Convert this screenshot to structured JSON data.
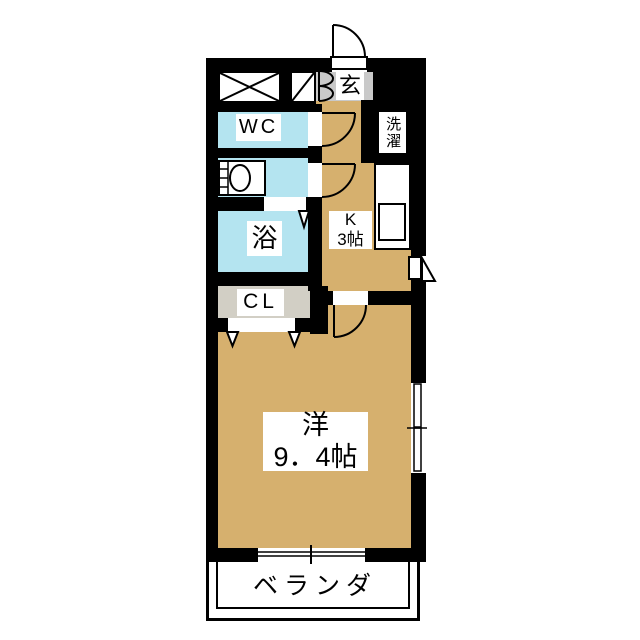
{
  "floorplan": {
    "rooms": {
      "entrance": {
        "label": "玄"
      },
      "toilet": {
        "label": "WC"
      },
      "laundry": {
        "label": "洗濯"
      },
      "bath": {
        "label": "浴"
      },
      "closet": {
        "label": "CL"
      },
      "kitchen": {
        "label": "K",
        "size": "3帖"
      },
      "western_room": {
        "label": "洋",
        "size": "9．4帖"
      },
      "veranda": {
        "label": "ベランダ"
      }
    },
    "colors": {
      "room_tan": "#d6b06e",
      "wet_area_blue": "#b4e4f0",
      "entrance_gray": "#c9c9c9",
      "closet_gray": "#d2cfc5",
      "wall_black": "#000000",
      "background": "#ffffff"
    }
  }
}
